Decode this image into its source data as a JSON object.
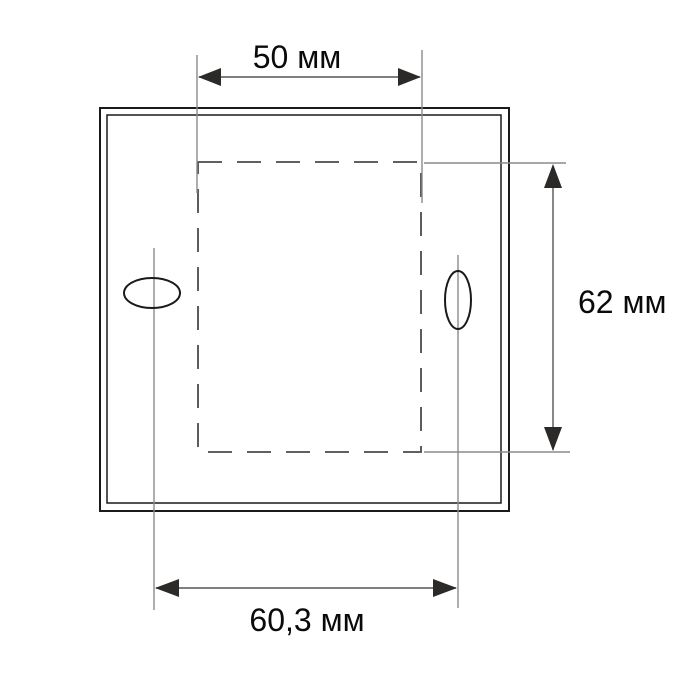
{
  "diagram": {
    "type": "technical-dimension-drawing",
    "subject": "square mounting frame with dashed cutout outline and two oval mounting holes",
    "dimensions": {
      "top": {
        "label": "50 мм",
        "value": 50,
        "unit": "мм",
        "measures": "cutout width"
      },
      "right": {
        "label": "62 мм",
        "value": 62,
        "unit": "мм",
        "measures": "cutout height"
      },
      "bottom": {
        "label": "60,3 мм",
        "value": 60.3,
        "unit": "мм",
        "measures": "distance between mounting holes"
      }
    }
  },
  "colors": {
    "background": "#ffffff",
    "frame_line": "#1a1a1a",
    "dashed_line": "#4a4a4a",
    "extension_line": "#8a8a8a",
    "dimension_line": "#555555",
    "arrowhead": "#2b2a28",
    "text": "#0a0a0a"
  }
}
